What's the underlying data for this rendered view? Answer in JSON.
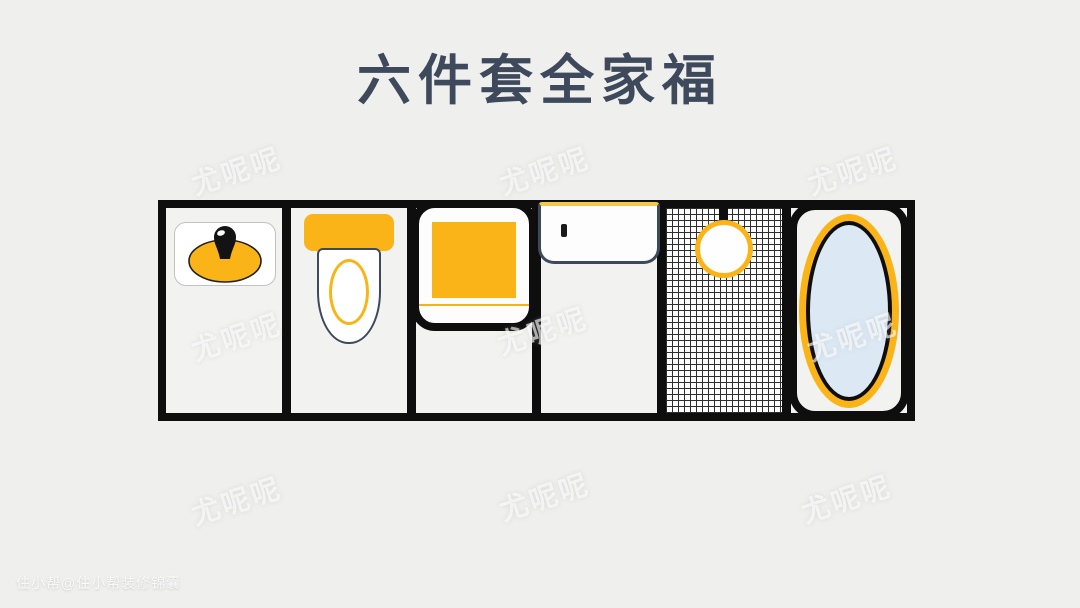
{
  "title": {
    "text": "六件套全家福"
  },
  "watermark": {
    "text": "尤呢呢"
  },
  "credit": {
    "text": "住小帮@住小帮装修锦囊"
  },
  "colors": {
    "background": "#EFEFEE",
    "panel_bg": "#F2F2F1",
    "outline_black": "#0E0E0E",
    "accent_yellow": "#FBB417",
    "pale_yellow": "#F2C94C",
    "tub_water_blue": "#DCE9F5",
    "dark_slate": "#3E4A5C",
    "white": "#FDFDFD"
  },
  "fixtures": {
    "items": [
      {
        "name": "washbasin"
      },
      {
        "name": "toilet"
      },
      {
        "name": "shower-tray"
      },
      {
        "name": "rectangular-bathtub"
      },
      {
        "name": "tiled-shower-room"
      },
      {
        "name": "oval-bathtub"
      }
    ]
  }
}
